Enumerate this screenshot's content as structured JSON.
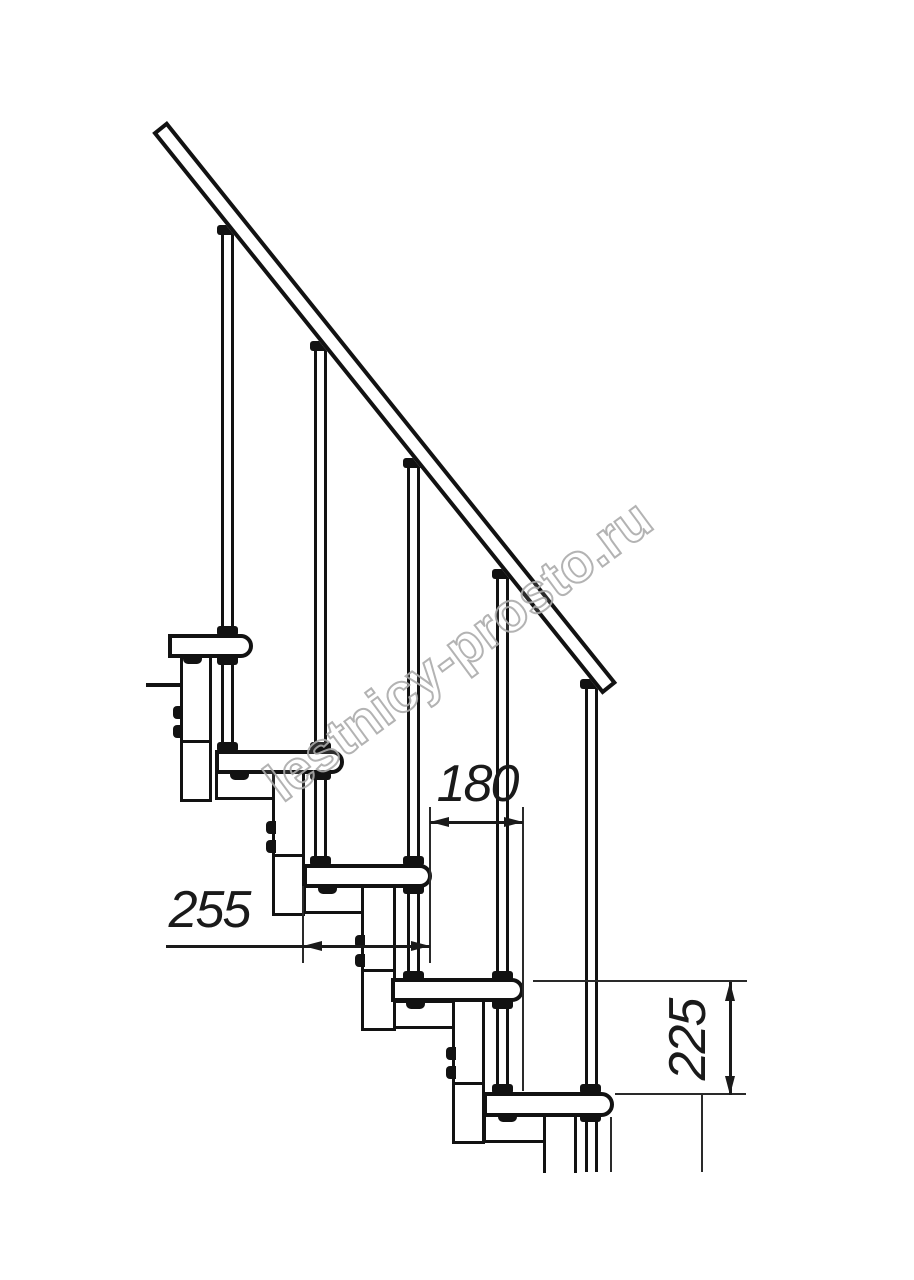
{
  "watermark": {
    "text": "lestnicy-prosto.ru"
  },
  "dimensions": {
    "tread_depth_label": "255",
    "step_run_label": "180",
    "riser_height_label": "225"
  },
  "drawing": {
    "type": "technical side-view of modular staircase",
    "colors": {
      "line": "#121212",
      "watermark_stroke": "#ababab",
      "background": "#ffffff"
    }
  }
}
